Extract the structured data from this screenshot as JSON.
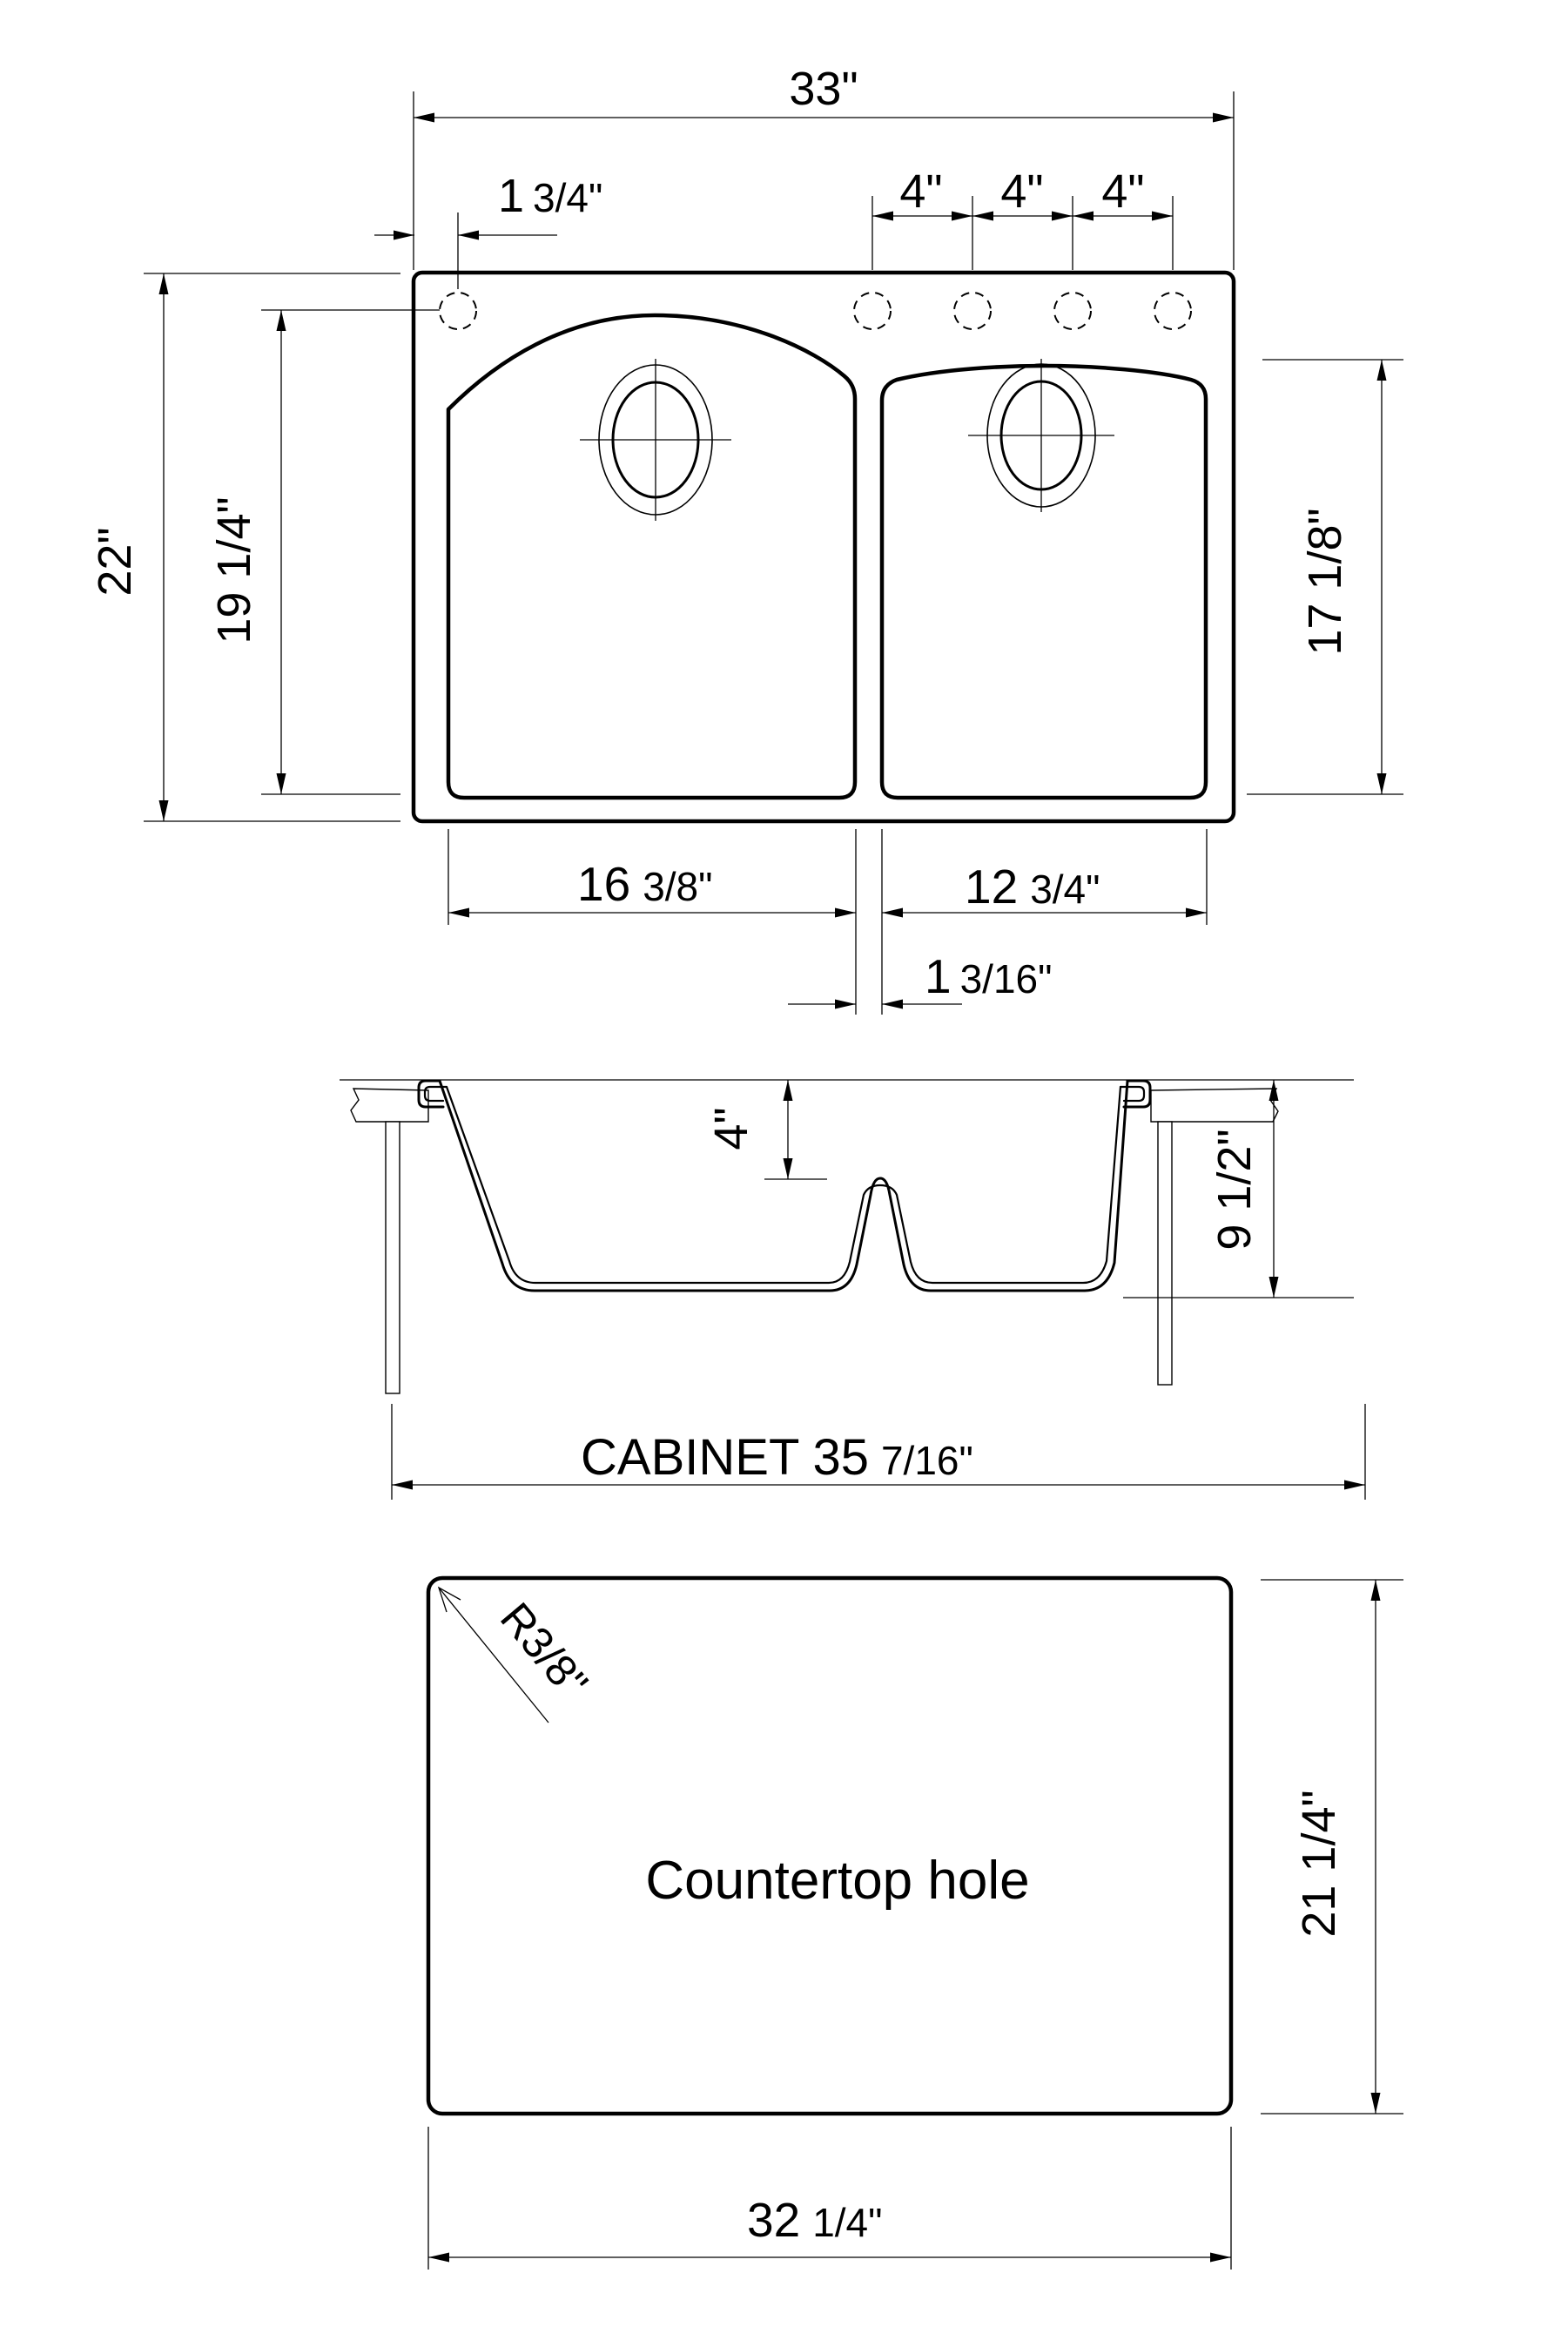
{
  "top_view": {
    "overall_width": "33\"",
    "faucet_offset": {
      "num": "1",
      "frac": "3/4\""
    },
    "faucet_spacing": [
      "4\"",
      "4\"",
      "4\""
    ],
    "overall_depth": "22\"",
    "left_bowl_depth": "19 1/4\"",
    "right_bowl_depth": "17 1/8\"",
    "left_bowl_width": {
      "num": "16",
      "frac": "3/8\""
    },
    "right_bowl_width": {
      "num": "12",
      "frac": "3/4\""
    },
    "divider_offset": {
      "num": "1",
      "frac": "3/16\""
    }
  },
  "section_view": {
    "divider_height": "4\"",
    "bowl_depth": "9 1/2\"",
    "cabinet_label": "CABINET 35",
    "cabinet_fraction": "7/16\""
  },
  "cutout_view": {
    "corner_radius": "R3/8\"",
    "label": "Countertop hole",
    "height": "21 1/4\"",
    "width": {
      "num": "32",
      "frac": "1/4\""
    }
  },
  "colors": {
    "line": "#000000",
    "background": "#ffffff"
  }
}
